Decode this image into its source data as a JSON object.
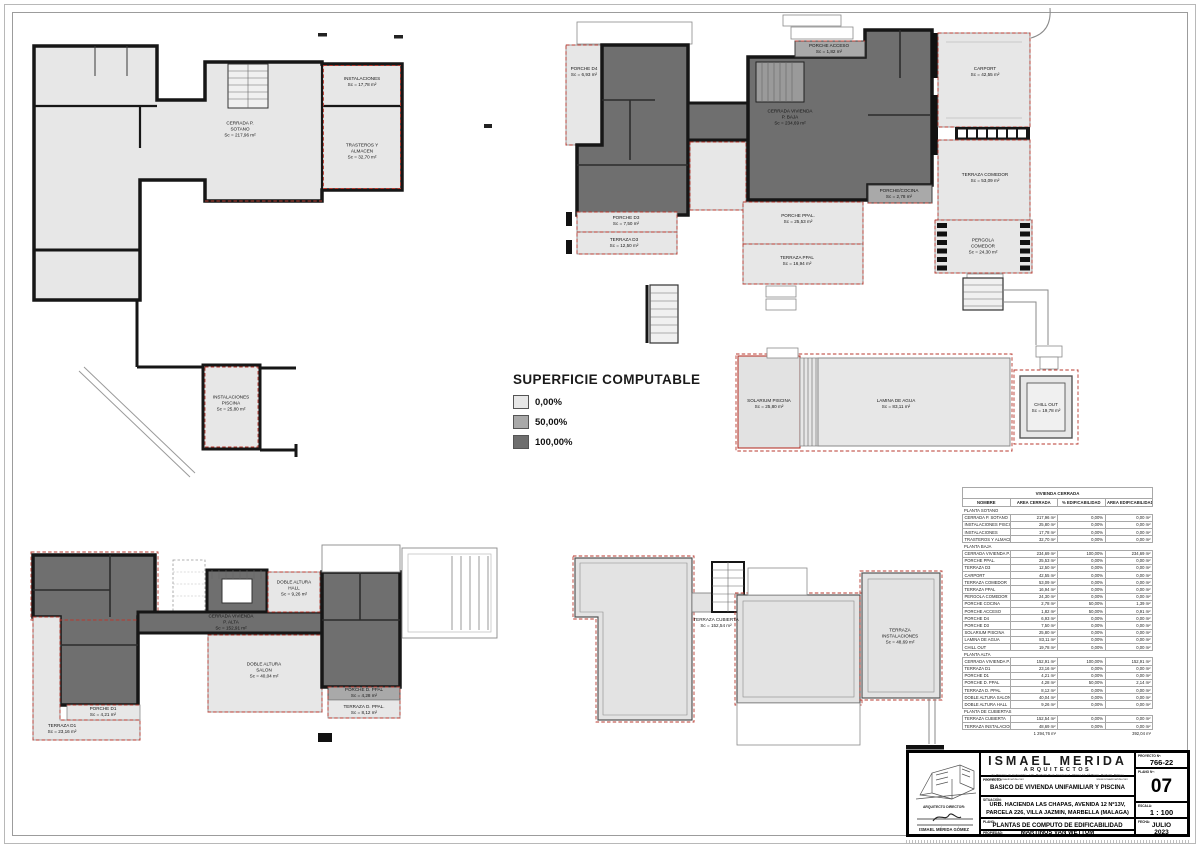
{
  "legend": {
    "title": "SUPERFICIE COMPUTABLE",
    "items": [
      {
        "label": "0,00%",
        "color": "#e7e7e7"
      },
      {
        "label": "50,00%",
        "color": "#a9a9a9"
      },
      {
        "label": "100,00%",
        "color": "#6f6f6f"
      }
    ]
  },
  "plans": {
    "sotano": {
      "rooms": [
        {
          "name": "INSTALACIONES",
          "sc": "Sc = 17,78 m²"
        },
        {
          "name": "CERRADA P.\nSOTANO",
          "sc": "Sc = 217,96 m²"
        },
        {
          "name": "TRASTEROS Y\nALMACEN",
          "sc": "Sc = 32,70 m²"
        },
        {
          "name": "INSTALACIONES\nPISCINA",
          "sc": "Sc = 25,80 m²"
        }
      ]
    },
    "baja": {
      "rooms": [
        {
          "name": "PORCHE D4",
          "sc": "Sc = 6,93 m²"
        },
        {
          "name": "PORCHE ACCESO",
          "sc": "Sc = 1,82 m²"
        },
        {
          "name": "CERRADA VIVIENDA\nP. BAJA",
          "sc": "Sc = 234,69 m²"
        },
        {
          "name": "CARPORT",
          "sc": "Sc = 42,55 m²"
        },
        {
          "name": "PORCHE/COCINA",
          "sc": "Sc = 2,78 m²"
        },
        {
          "name": "TERRAZA COMEDOR",
          "sc": "Sc = 53,09 m²"
        },
        {
          "name": "PERGOLA\nCOMEDOR",
          "sc": "Sc = 24,30 m²"
        },
        {
          "name": "PORCHE D3",
          "sc": "Sc = 7,50 m²"
        },
        {
          "name": "TERRAZA D3",
          "sc": "Sc = 12,50 m²"
        },
        {
          "name": "PORCHE PPAL.",
          "sc": "Sc = 25,53 m²"
        },
        {
          "name": "TERRAZA PPAL",
          "sc": "Sc = 16,94 m²"
        },
        {
          "name": "SOLARIUM PISCINA",
          "sc": "Sc = 25,80 m²"
        },
        {
          "name": "LAMINA DE AGUA",
          "sc": "Sc = 83,11 m²"
        },
        {
          "name": "CHILL OUT",
          "sc": "Sc = 19,78 m²"
        }
      ]
    },
    "alta": {
      "rooms": [
        {
          "name": "DOBLE ALTURA\nHALL",
          "sc": "Sc = 9,26 m²"
        },
        {
          "name": "CERRADA VIVIENDA\nP. ALTA",
          "sc": "Sc = 152,91 m²"
        },
        {
          "name": "DOBLE ALTURA\nSALON",
          "sc": "Sc = 40,04 m²"
        },
        {
          "name": "PORCHE D1",
          "sc": "Sc = 4,21 m²"
        },
        {
          "name": "TERRAZA D1",
          "sc": "Sc = 23,16 m²"
        },
        {
          "name": "PORCHE D. PPAL",
          "sc": "Sc = 4,28 m²"
        },
        {
          "name": "TERRAZA D. PPAL.",
          "sc": "Sc = 8,12 m²"
        }
      ]
    },
    "cubierta": {
      "rooms": [
        {
          "name": "TERRAZA CUBIERTA",
          "sc": "Sc = 152,54 m²"
        },
        {
          "name": "TERRAZA\nINSTALACIONES",
          "sc": "Sc = 48,69 m²"
        }
      ]
    }
  },
  "table": {
    "title": "VIVIENDA CERRADA",
    "columns": [
      "NOMBRE",
      "AREA CERRADA",
      "% EDIFICABILIDAD",
      "AREA EDIFICABILIDAD"
    ],
    "rows": [
      {
        "type": "section",
        "name": "PLANTA SOTANO"
      },
      {
        "name": "CERRADA P. SOTANO",
        "area": "217,96 m²",
        "pct": "0,00%",
        "edif": "0,00 m²"
      },
      {
        "name": "INSTALACIONES PISCINA",
        "area": "25,80 m²",
        "pct": "0,00%",
        "edif": "0,00 m²"
      },
      {
        "name": "INSTALACIONES",
        "area": "17,78 m²",
        "pct": "0,00%",
        "edif": "0,00 m²"
      },
      {
        "name": "TRASTEROS Y ALMACEN",
        "area": "32,70 m²",
        "pct": "0,00%",
        "edif": "0,00 m²"
      },
      {
        "type": "section",
        "name": "PLANTA BAJA"
      },
      {
        "name": "CERRADA VIVIENDA P. BAJA",
        "area": "234,69 m²",
        "pct": "100,00%",
        "edif": "234,69 m²"
      },
      {
        "name": "PORCHE PPAL.",
        "area": "25,53 m²",
        "pct": "0,00%",
        "edif": "0,00 m²"
      },
      {
        "name": "TERRAZA D3",
        "area": "12,50 m²",
        "pct": "0,00%",
        "edif": "0,00 m²"
      },
      {
        "name": "CARPORT",
        "area": "42,55 m²",
        "pct": "0,00%",
        "edif": "0,00 m²"
      },
      {
        "name": "TERRAZA COMEDOR",
        "area": "53,09 m²",
        "pct": "0,00%",
        "edif": "0,00 m²"
      },
      {
        "name": "TERRAZA PPAL",
        "area": "16,94 m²",
        "pct": "0,00%",
        "edif": "0,00 m²"
      },
      {
        "name": "PERGOLA COMEDOR",
        "area": "24,30 m²",
        "pct": "0,00%",
        "edif": "0,00 m²"
      },
      {
        "name": "PORCHE COCINA",
        "area": "2,78 m²",
        "pct": "50,00%",
        "edif": "1,39 m²"
      },
      {
        "name": "PORCHE ACCESO",
        "area": "1,82 m²",
        "pct": "50,00%",
        "edif": "0,91 m²"
      },
      {
        "name": "PORCHE D4",
        "area": "6,93 m²",
        "pct": "0,00%",
        "edif": "0,00 m²"
      },
      {
        "name": "PORCHE D3",
        "area": "7,50 m²",
        "pct": "0,00%",
        "edif": "0,00 m²"
      },
      {
        "name": "SOLARIUM PISCINA",
        "area": "25,80 m²",
        "pct": "0,00%",
        "edif": "0,00 m²"
      },
      {
        "name": "LAMINA DE AGUA",
        "area": "83,11 m²",
        "pct": "0,00%",
        "edif": "0,00 m²"
      },
      {
        "name": "CHILL OUT",
        "area": "19,78 m²",
        "pct": "0,00%",
        "edif": "0,00 m²"
      },
      {
        "type": "section",
        "name": "PLANTA ALTA"
      },
      {
        "name": "CERRADA VIVIENDA P. ALTA",
        "area": "152,91 m²",
        "pct": "100,00%",
        "edif": "152,91 m²"
      },
      {
        "name": "TERRAZA D1",
        "area": "23,16 m²",
        "pct": "0,00%",
        "edif": "0,00 m²"
      },
      {
        "name": "PORCHE D1",
        "area": "4,21 m²",
        "pct": "0,00%",
        "edif": "0,00 m²"
      },
      {
        "name": "PORCHE D. PPAL",
        "area": "4,28 m²",
        "pct": "50,00%",
        "edif": "2,14 m²"
      },
      {
        "name": "TERRAZA D. PPAL",
        "area": "8,12 m²",
        "pct": "0,00%",
        "edif": "0,00 m²"
      },
      {
        "name": "DOBLE ALTURA SALON",
        "area": "40,04 m²",
        "pct": "0,00%",
        "edif": "0,00 m²"
      },
      {
        "name": "DOBLE ALTURA HALL",
        "area": "9,26 m²",
        "pct": "0,00%",
        "edif": "0,00 m²"
      },
      {
        "type": "section",
        "name": "PLANTA DE CUBIERTAS"
      },
      {
        "name": "TERRAZA CUBIERTA",
        "area": "152,54 m²",
        "pct": "0,00%",
        "edif": "0,00 m²"
      },
      {
        "name": "TERRAZA INSTALACIONES",
        "area": "48,69 m²",
        "pct": "0,00%",
        "edif": "0,00 m²"
      }
    ],
    "total": {
      "area": "1 294,76 m²",
      "edif": "392,04 m²"
    }
  },
  "titleblock": {
    "firm_name": "ISMAEL MERIDA",
    "firm_sub": "ARQUITECTOS",
    "firm_address": "Av. Príncipe de Hohenlohe - Urb. Marbella Real, Escalera 3, Oficina 10, 1ª Planta, Marbella, Málaga",
    "firm_email": "estudio@ismaelmerida.com",
    "firm_web": "www.ismaelmerida.com",
    "proyecto_no_label": "PROYECTO Nº:",
    "proyecto_no": "766-22",
    "plano_no_label": "PLANO Nº:",
    "plano_no": "07",
    "proyecto_label": "PROYECTO:",
    "proyecto": "BASICO DE VIVIENDA UNIFAMILIAR Y PISCINA",
    "situacion_label": "SITUACIÓN:",
    "situacion_1": "URB. HACIENDA LAS CHAPAS, AVENIDA 12 Nº13V,",
    "situacion_2": "PARCELA 226, VILLA JAZMIN, MARBELLA (MALAGA)",
    "plano_label": "PLANO:",
    "plano": "PLANTAS DE COMPUTO DE EDIFICABILIDAD",
    "propiedad_label": "PROPIEDAD:",
    "propiedad": "MARTINUS VAN WETTUM",
    "escala_label": "ESCALA:",
    "escala": "1 : 100",
    "fecha_label": "FECHA:",
    "fecha_1": "JULIO",
    "fecha_2": "2023",
    "arquitecto_label": "ARQUITECTO DIRECTOR:",
    "arquitecto": "ISMAEL MÉRIDA GÓMEZ"
  }
}
